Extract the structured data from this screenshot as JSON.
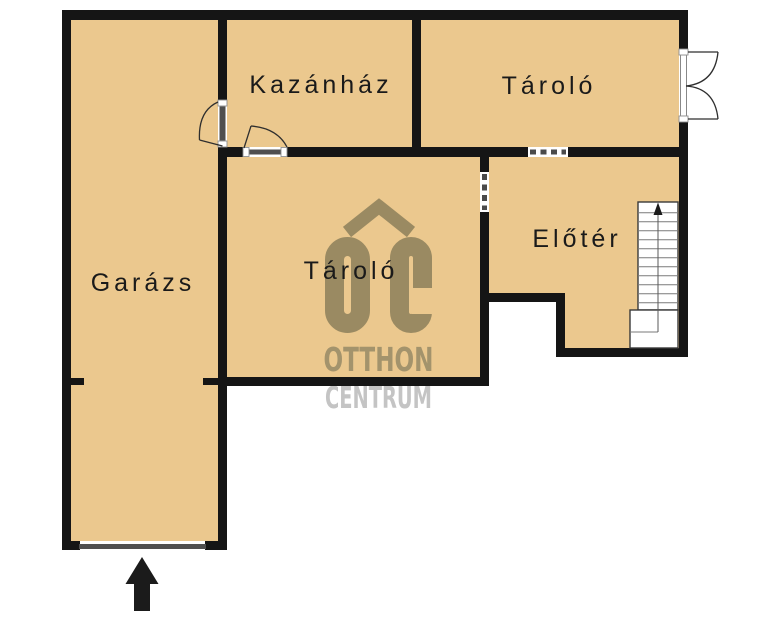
{
  "image_type": "real-estate floor plan",
  "floorplan": {
    "colors": {
      "room_fill": "#ebc88e",
      "wall": "#151515",
      "label_text": "#1a1a1a",
      "door_gray": "#4f4f4f",
      "stair_lines": "#7a7a7a",
      "entry_arrow": "#1b1b1b"
    },
    "rooms": [
      {
        "id": "garazs",
        "label": "Garázs"
      },
      {
        "id": "kazanhaz",
        "label": "Kazánház"
      },
      {
        "id": "tarolo_top",
        "label": "Tároló"
      },
      {
        "id": "tarolo_middle",
        "label": "Tároló"
      },
      {
        "id": "eloter",
        "label": "Előtér"
      }
    ],
    "stairs": {
      "direction": "up"
    },
    "entry": {
      "symbol": "arrow-up"
    }
  },
  "watermark": {
    "monogram": "OC",
    "name_line1": "OTTHON",
    "name_line2": "CENTRUM",
    "monogram_color": "#9a8a62",
    "line1_color": "#a3936c",
    "line2_color": "#c4c4c4"
  }
}
